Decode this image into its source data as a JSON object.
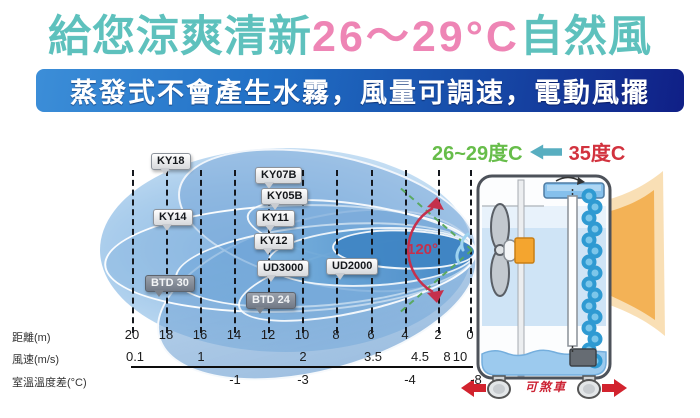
{
  "title": {
    "prefix": "給您涼爽清新",
    "range": "26～29°C",
    "suffix": "自然風"
  },
  "subtitle": "蒸發式不會產生水霧，風量可調速，電動風擺",
  "flow_header": {
    "cool": "26~29度C",
    "hot": "35度C"
  },
  "angle_label": "120°",
  "brake_label": "可煞車",
  "colors": {
    "title_teal": "#5ec1bd",
    "title_pink": "#ee85b5",
    "banner_blue": "#1648a6",
    "cool_green": "#67bd4a",
    "hot_red": "#d2323e",
    "arrow_teal": "#58aec0",
    "angle_red": "#c5304c",
    "brake_red": "#cc2233",
    "plume_blue": "#6ba3d6",
    "warm_air_orange": "#f1a63f"
  },
  "models": [
    {
      "name": "KY18",
      "x": 151,
      "y": 35,
      "variant": "light"
    },
    {
      "name": "KY07B",
      "x": 255,
      "y": 49,
      "variant": "light"
    },
    {
      "name": "KY05B",
      "x": 261,
      "y": 70,
      "variant": "light"
    },
    {
      "name": "KY14",
      "x": 153,
      "y": 91,
      "variant": "light"
    },
    {
      "name": "KY11",
      "x": 256,
      "y": 92,
      "variant": "light"
    },
    {
      "name": "KY12",
      "x": 254,
      "y": 115,
      "variant": "light"
    },
    {
      "name": "UD3000",
      "x": 257,
      "y": 142,
      "variant": "light"
    },
    {
      "name": "UD2000",
      "x": 326,
      "y": 140,
      "variant": "light"
    },
    {
      "name": "BTD 30",
      "x": 145,
      "y": 157,
      "variant": "dark"
    },
    {
      "name": "BTD 24",
      "x": 246,
      "y": 174,
      "variant": "dark"
    }
  ],
  "axes": {
    "distance": {
      "label": "距離(m)",
      "ticks": [
        {
          "v": "20",
          "x": 132
        },
        {
          "v": "18",
          "x": 166
        },
        {
          "v": "16",
          "x": 200
        },
        {
          "v": "14",
          "x": 234
        },
        {
          "v": "12",
          "x": 268
        },
        {
          "v": "10",
          "x": 302
        },
        {
          "v": "8",
          "x": 336
        },
        {
          "v": "6",
          "x": 371
        },
        {
          "v": "4",
          "x": 405
        },
        {
          "v": "2",
          "x": 438
        },
        {
          "v": "0",
          "x": 470
        }
      ]
    },
    "wind": {
      "label": "風速(m/s)",
      "ticks": [
        {
          "v": "0.1",
          "x": 135
        },
        {
          "v": "1",
          "x": 201
        },
        {
          "v": "2",
          "x": 303
        },
        {
          "v": "3.5",
          "x": 373
        },
        {
          "v": "4.5",
          "x": 420
        },
        {
          "v": "8",
          "x": 447
        },
        {
          "v": "10",
          "x": 460
        }
      ]
    },
    "temp": {
      "label": "室溫溫度差(°C)",
      "ticks": [
        {
          "v": "-1",
          "x": 235
        },
        {
          "v": "-3",
          "x": 303
        },
        {
          "v": "-4",
          "x": 410
        },
        {
          "v": "-8",
          "x": 476
        }
      ]
    }
  }
}
